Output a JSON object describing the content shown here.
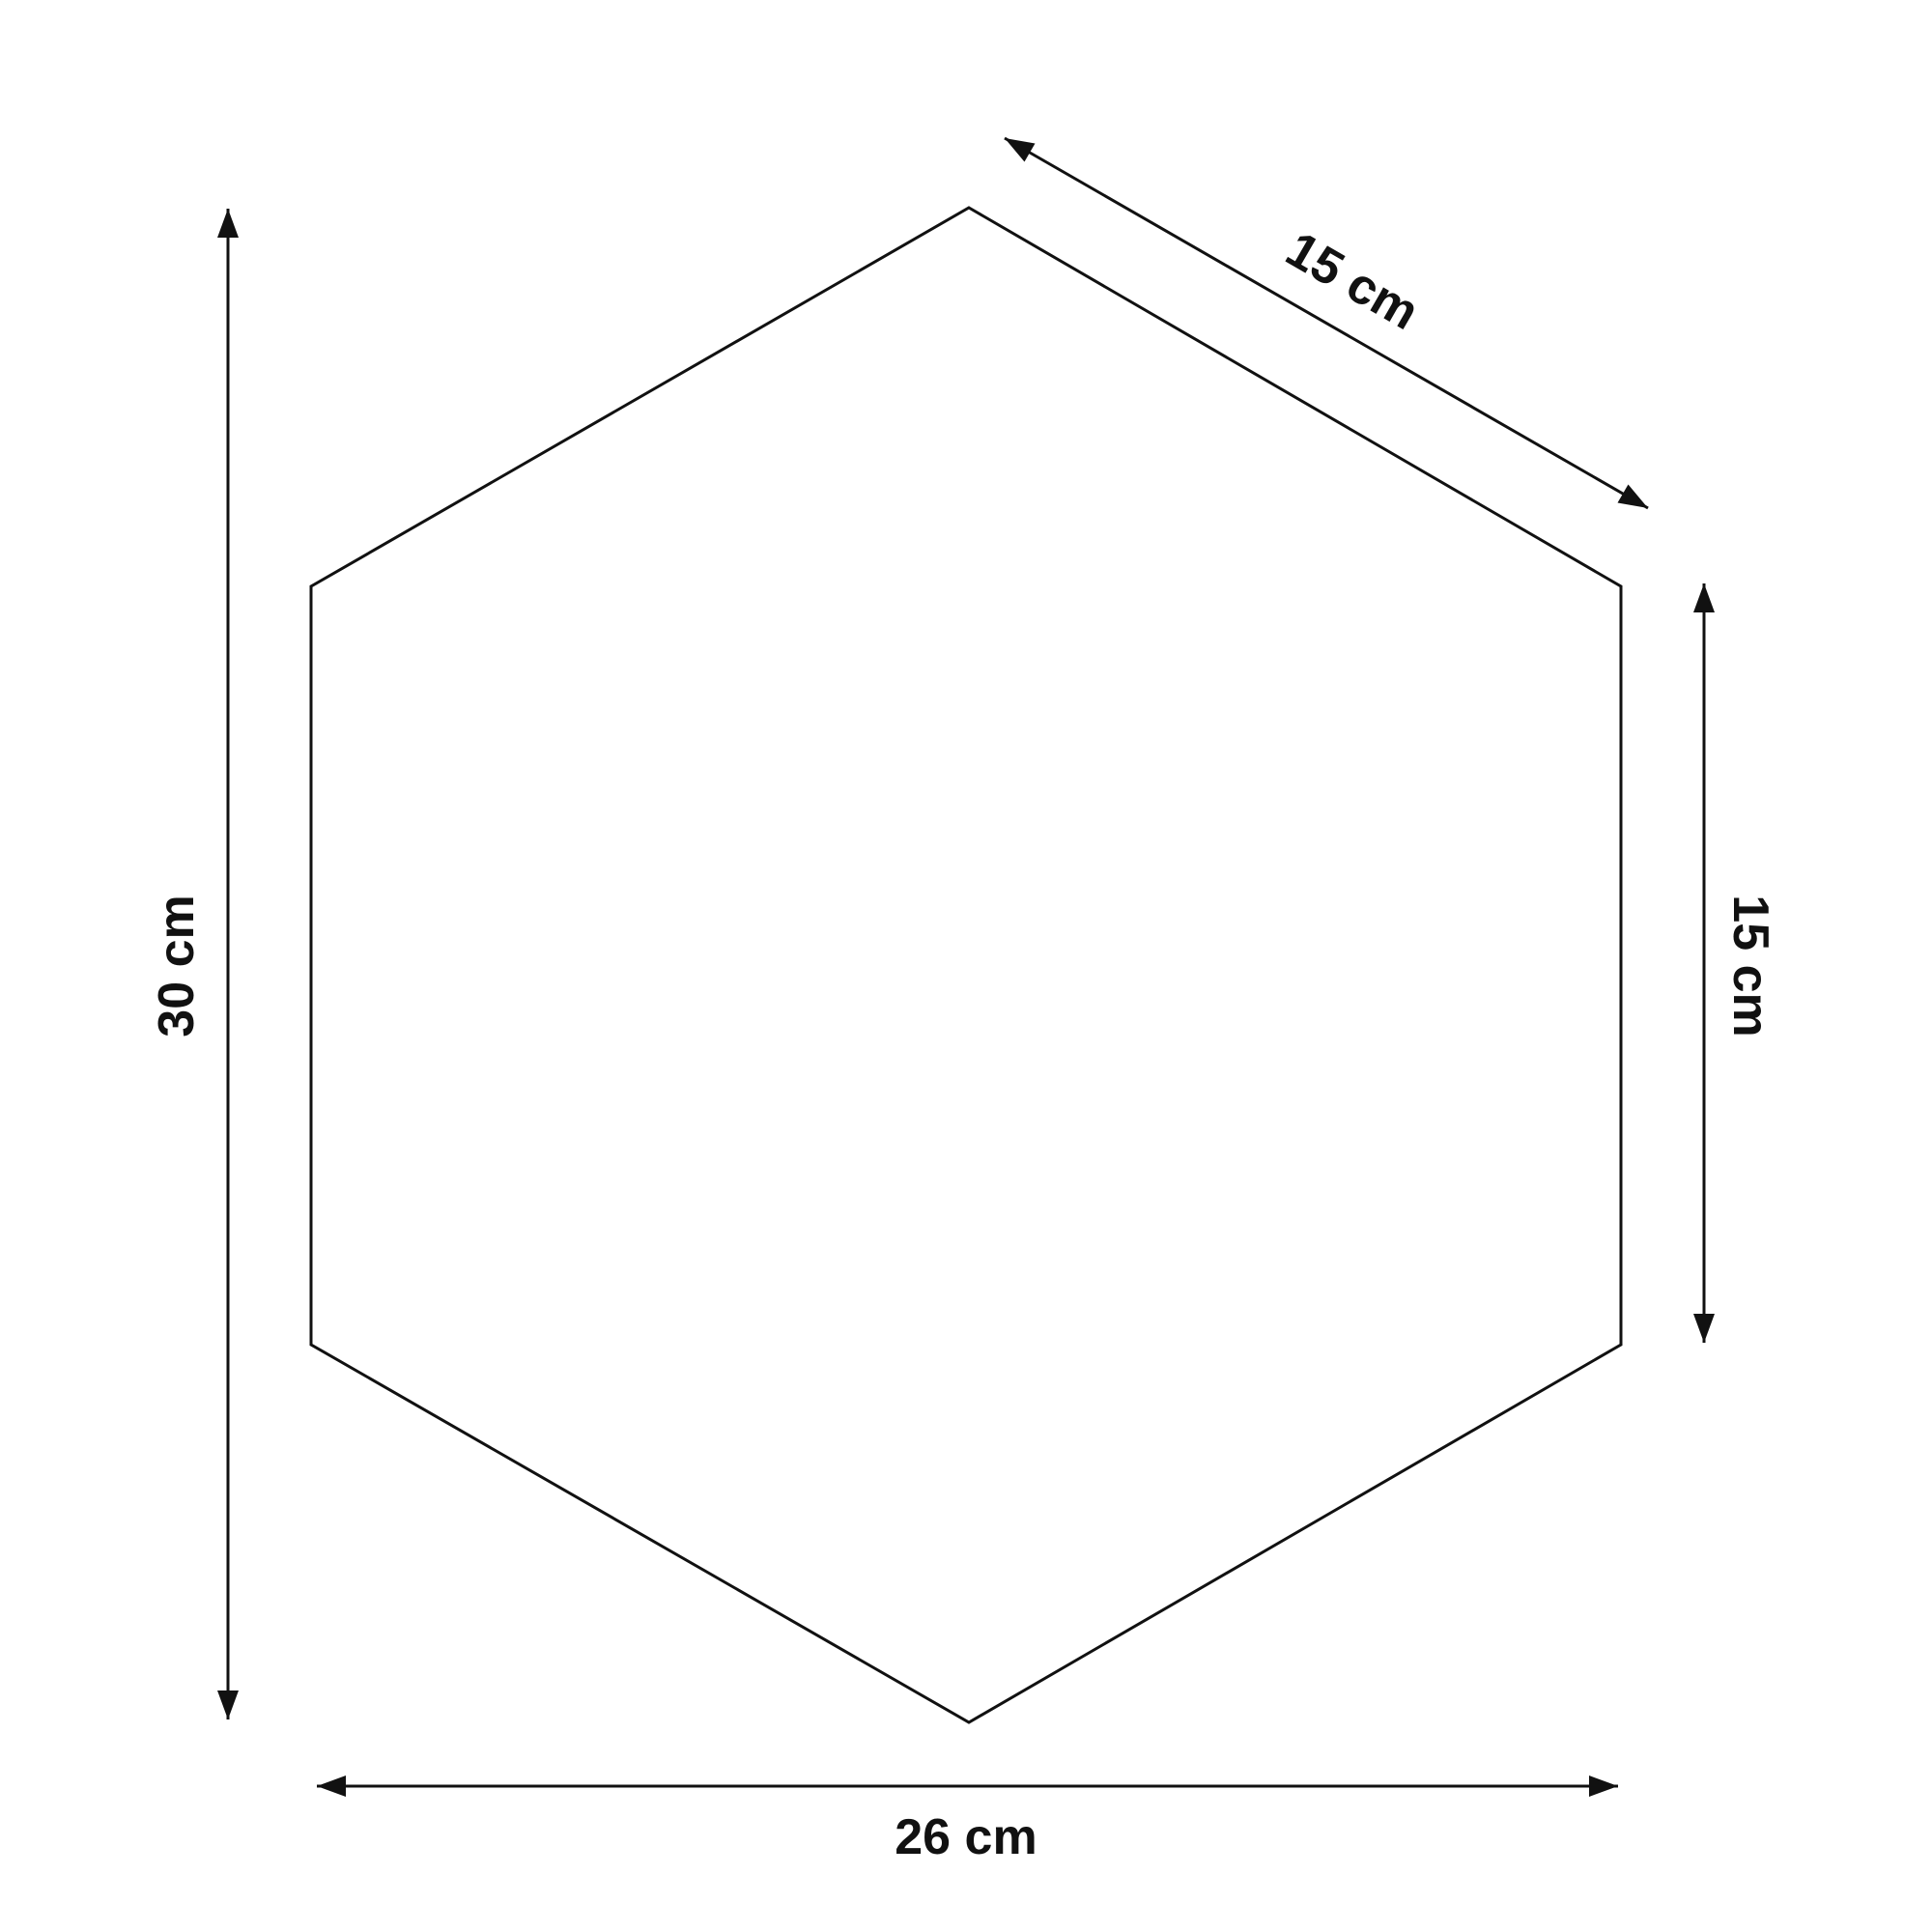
{
  "diagram": {
    "shape": "hexagon",
    "colors": {
      "background": "#ffffff",
      "line": "#111111",
      "text": "#111111"
    },
    "icons": {
      "arrowhead": "filled-triangle"
    },
    "dimensions": {
      "height_label": "30 cm",
      "slant_edge_label": "15 cm",
      "right_side_label": "15 cm",
      "width_label": "26 cm"
    }
  }
}
